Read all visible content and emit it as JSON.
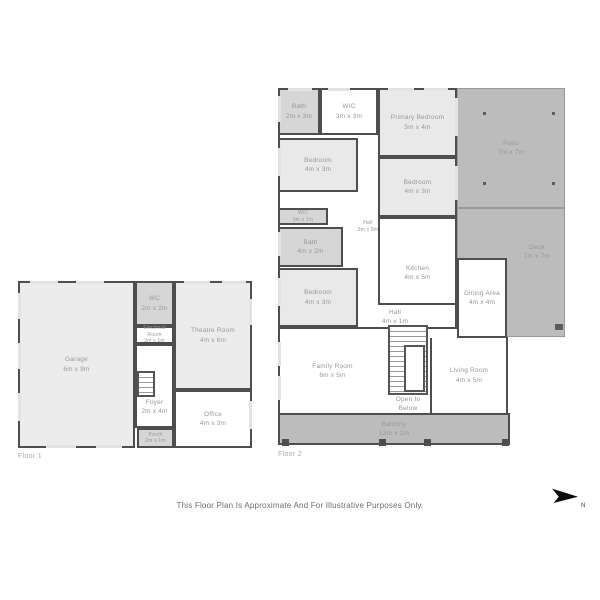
{
  "meta": {
    "disclaimer": "This Floor Plan Is Approximate And For Illustrative Purposes Only.",
    "north_label": "N"
  },
  "floor1": {
    "label": "Floor 1",
    "rooms": {
      "garage": {
        "name": "Garage",
        "dims": "6m x 9m"
      },
      "wc": {
        "name": "WC",
        "dims": "2m x 2m"
      },
      "electrical": {
        "name": "Electrical Room",
        "dims": "2m x 1m"
      },
      "theatre": {
        "name": "Theatre Room",
        "dims": "4m x 6m"
      },
      "foyer": {
        "name": "Foyer",
        "dims": "2m x 4m"
      },
      "office": {
        "name": "Office",
        "dims": "4m x 3m"
      },
      "porch": {
        "name": "Porch",
        "dims": "2m x 1m"
      }
    }
  },
  "floor2": {
    "label": "Floor 2",
    "rooms": {
      "bath_top": {
        "name": "Bath",
        "dims": "2m x 3m"
      },
      "wic_top": {
        "name": "WIC",
        "dims": "3m x 3m"
      },
      "primary_bedroom": {
        "name": "Primary Bedroom",
        "dims": "5m x 4m"
      },
      "patio": {
        "name": "Patio",
        "dims": "7m x 7m"
      },
      "bedroom_upper": {
        "name": "Bedroom",
        "dims": "4m x 3m"
      },
      "bedroom_right": {
        "name": "Bedroom",
        "dims": "4m x 3m"
      },
      "deck": {
        "name": "Deck",
        "dims": "7m x 7m"
      },
      "wic_small": {
        "name": "WIC",
        "dims": "3m x 1m"
      },
      "hall_upper": {
        "name": "Hall",
        "dims": "3m x 8m"
      },
      "bath_mid": {
        "name": "Bath",
        "dims": "4m x 2m"
      },
      "bedroom_lower": {
        "name": "Bedroom",
        "dims": "4m x 3m"
      },
      "kitchen": {
        "name": "Kitchen",
        "dims": "4m x 5m"
      },
      "hall_lower": {
        "name": "Hall",
        "dims": "4m x 1m"
      },
      "dining": {
        "name": "Dining Area",
        "dims": "4m x 4m"
      },
      "family": {
        "name": "Family Room",
        "dims": "6m x 5m"
      },
      "living": {
        "name": "Living Room",
        "dims": "4m x 5m"
      },
      "open_below": {
        "name": "Open to",
        "dims": "Below"
      },
      "balcony": {
        "name": "Balcony",
        "dims": "13m x 2m"
      }
    }
  }
}
